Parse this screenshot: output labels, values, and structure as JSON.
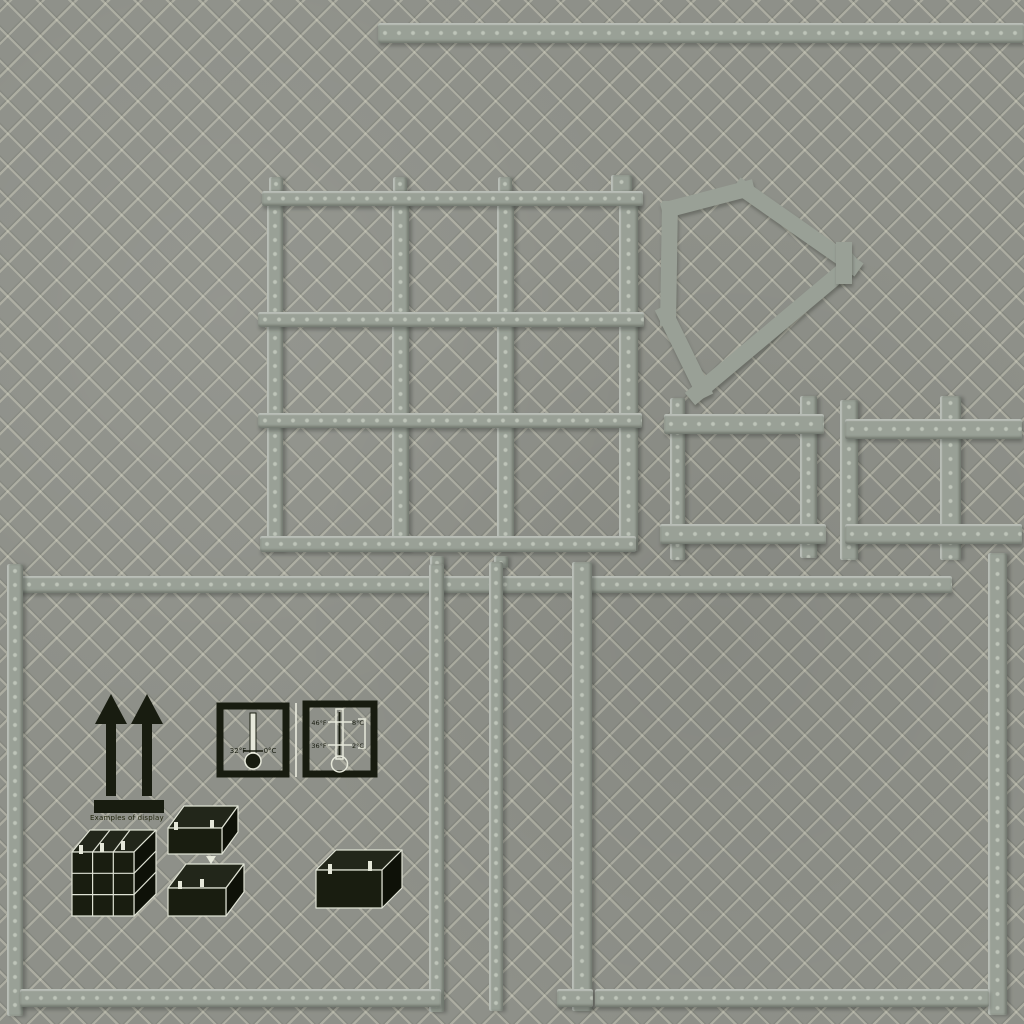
{
  "texture": {
    "kind": "quilted-crate-texture",
    "colors": {
      "base": "#8e9089",
      "pattern_light": "#d5d4c2",
      "seam": "#99a096",
      "ink": "#181c10",
      "print_white": "#e6e8da"
    }
  },
  "markings": {
    "caption": "Examples of display",
    "freeze_icon": {
      "fahrenheit": "32°F",
      "celsius": "0°C"
    },
    "range_icon": {
      "upper_f": "46°F",
      "upper_c": "8°C",
      "lower_f": "36°F",
      "lower_c": "2°C"
    },
    "icons": [
      "this-way-up-icon",
      "keep-from-freezing-icon",
      "temperature-range-icon",
      "stacked-boxes-icon",
      "stack-two-boxes-icon",
      "single-box-icon"
    ]
  }
}
